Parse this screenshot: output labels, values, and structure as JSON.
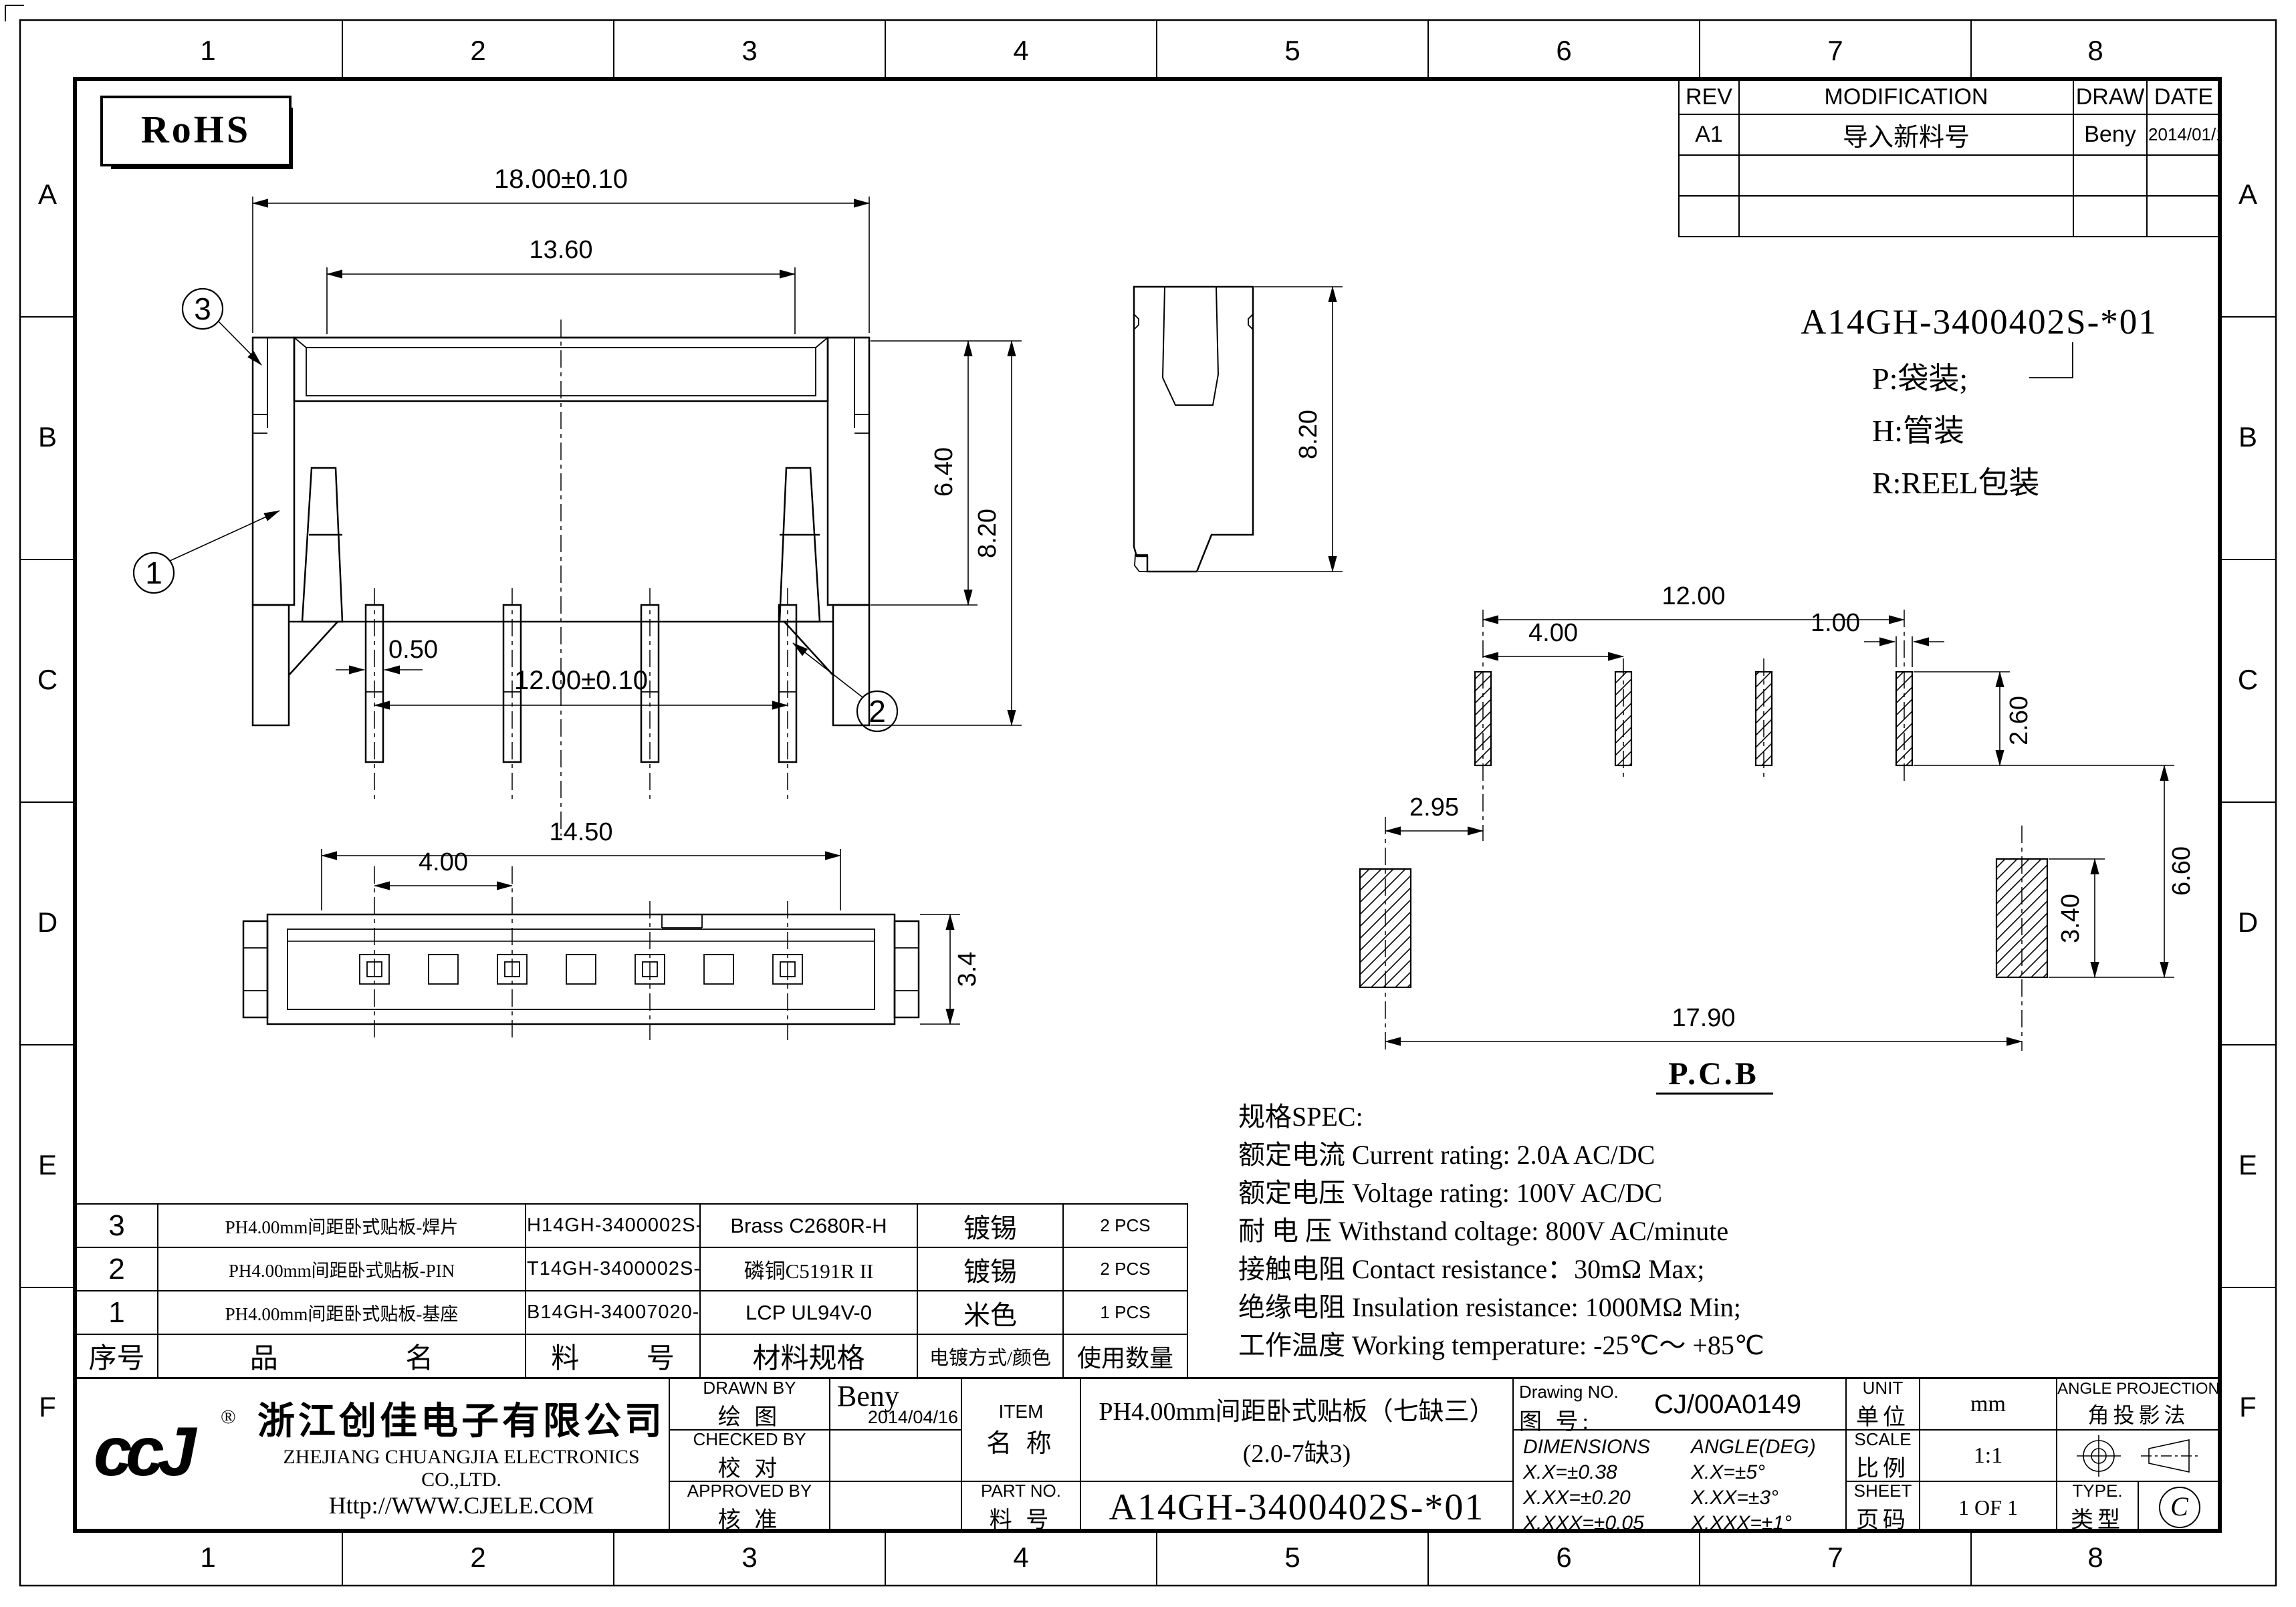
{
  "grid": {
    "cols": [
      "1",
      "2",
      "3",
      "4",
      "5",
      "6",
      "7",
      "8"
    ],
    "rows": [
      "A",
      "B",
      "C",
      "D",
      "E",
      "F"
    ]
  },
  "rohs_label": "RoHS",
  "rev_table": {
    "headers": [
      "REV",
      "MODIFICATION",
      "DRAW",
      "DATE"
    ],
    "row": {
      "rev": "A1",
      "modification": "导入新料号",
      "draw": "Beny",
      "date": "2014/01/16"
    }
  },
  "part_code": {
    "code": "A14GH-3400402S-*01",
    "legend": [
      "P:袋装;",
      "H:管装",
      "R:REEL包装"
    ]
  },
  "dims": {
    "f18": "18.00±0.10",
    "f136": "13.60",
    "f64": "6.40",
    "f82": "8.20",
    "f05": "0.50",
    "f12": "12.00±0.10",
    "s82": "8.20",
    "t145": "14.50",
    "t4": "4.00",
    "t34": "3.4",
    "p12": "12.00",
    "p4": "4.00",
    "p1": "1.00",
    "p26": "2.60",
    "p295": "2.95",
    "p34": "3.40",
    "p66": "6.60",
    "p179": "17.90",
    "pcb_label": "P.C.B"
  },
  "balloons": {
    "b1": "1",
    "b2": "2",
    "b3": "3"
  },
  "spec": {
    "title": "规格SPEC:",
    "rows": [
      "额定电流 Current rating: 2.0A AC/DC",
      "额定电压 Voltage rating: 100V AC/DC",
      "耐 电 压 Withstand coltage: 800V AC/minute",
      "接触电阻 Contact resistance：30mΩ Max;",
      "绝缘电阻 Insulation resistance: 1000MΩ Min;",
      "工作温度 Working temperature: -25℃～ +85℃"
    ]
  },
  "bom": {
    "headers": {
      "no": "序号",
      "name": "品 名",
      "pn": "料 号",
      "material": "材料规格",
      "plating": "电镀方式/颜色",
      "qty": "使用数量"
    },
    "rows": [
      {
        "no": "3",
        "name": "PH4.00mm间距卧式贴板-焊片",
        "pn": "H14GH-3400002S-A01",
        "material": "Brass C2680R-H",
        "plating": "镀锡",
        "qty": "2 PCS"
      },
      {
        "no": "2",
        "name": "PH4.00mm间距卧式贴板-PIN",
        "pn": "T14GH-3400002S-A01",
        "material": "磷铜C5191R II",
        "plating": "镀锡",
        "qty": "2 PCS"
      },
      {
        "no": "1",
        "name": "PH4.00mm间距卧式贴板-基座",
        "pn": "B14GH-34007020-P01",
        "material": "LCP UL94V-0",
        "plating": "米色",
        "qty": "1 PCS"
      }
    ]
  },
  "title_block": {
    "logo": "ccJ",
    "reg": "®",
    "company_cn": "浙江创佳电子有限公司",
    "company_en": "ZHEJIANG CHUANGJIA ELECTRONICS CO.,LTD.",
    "website": "Http://WWW.CJELE.COM",
    "drawn": {
      "en": "DRAWN BY",
      "cn": "绘 图",
      "value": "Beny",
      "date": "2014/04/16"
    },
    "checked": {
      "en": "CHECKED BY",
      "cn": "校 对",
      "value": ""
    },
    "approved": {
      "en": "APPROVED BY",
      "cn": "核 准",
      "value": ""
    },
    "item": {
      "en": "ITEM",
      "cn": "名 称",
      "line1": "PH4.00mm间距卧式贴板（七缺三）",
      "line2": "(2.0-7缺3)"
    },
    "part_no": {
      "en": "PART NO.",
      "cn": "料 号",
      "value": "A14GH-3400402S-*01"
    },
    "drawing_no": {
      "en": "Drawing NO.",
      "cn": "图 号:",
      "value": "CJ/00A0149"
    },
    "dim_tol": {
      "title": "DIMENSIONS",
      "l1": "X.X=±0.38",
      "l2": "X.XX=±0.20",
      "l3": "X.XXX=±0.05"
    },
    "ang_tol": {
      "title": "ANGLE(DEG)",
      "l1": "X.X=±5°",
      "l2": "X.XX=±3°",
      "l3": "X.XXX=±1°"
    },
    "unit": {
      "en": "UNIT",
      "cn": "单位",
      "value": "mm"
    },
    "scale": {
      "en": "SCALE",
      "cn": "比例",
      "value": "1:1"
    },
    "sheet": {
      "en": "SHEET",
      "cn": "页码",
      "value": "1 OF 1"
    },
    "projection": {
      "en": "ANGLE PROJECTION",
      "cn": "角投影法"
    },
    "type": {
      "en": "TYPE.",
      "cn": "类型",
      "value": "C"
    }
  }
}
